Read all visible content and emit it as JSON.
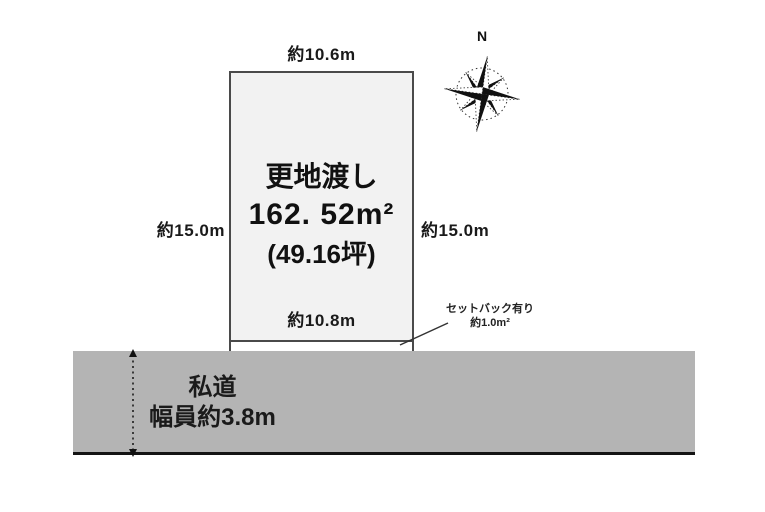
{
  "compass": {
    "north_label": "N"
  },
  "plot": {
    "dim_top": "約10.6m",
    "dim_left": "約15.0m",
    "dim_right": "約15.0m",
    "dim_bottom": "約10.8m",
    "title": "更地渡し",
    "area_sqm": "162. 52m²",
    "area_tsubo": "(49.16坪)"
  },
  "setback": {
    "line1": "セットバック有り",
    "line2": "約1.0m²"
  },
  "road": {
    "name": "私道",
    "width_label": "幅員約3.8m"
  },
  "colors": {
    "plot_fill": "#f2f2f2",
    "plot_border": "#4a4a4a",
    "road_fill": "#b4b4b4",
    "road_baseline": "#141414",
    "ink": "#111111"
  }
}
